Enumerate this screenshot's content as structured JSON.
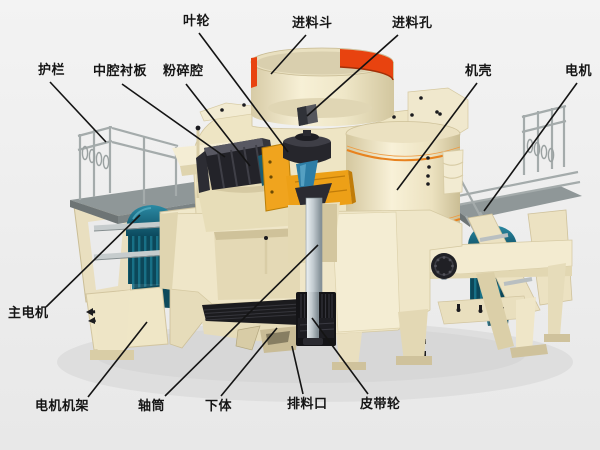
{
  "labels": [
    {
      "id": "impeller",
      "text": "叶轮",
      "tx": 183,
      "ty": 14,
      "line": {
        "x1": 199,
        "y1": 33,
        "x2": 288,
        "y2": 152
      }
    },
    {
      "id": "feed-hopper",
      "text": "进料斗",
      "tx": 292,
      "ty": 16,
      "line": {
        "x1": 306,
        "y1": 35,
        "x2": 271,
        "y2": 74
      }
    },
    {
      "id": "feed-opening",
      "text": "进料孔",
      "tx": 392,
      "ty": 16,
      "line": {
        "x1": 398,
        "y1": 35,
        "x2": 307,
        "y2": 116
      }
    },
    {
      "id": "guardrail",
      "text": "护栏",
      "tx": 38,
      "ty": 63,
      "line": {
        "x1": 50,
        "y1": 82,
        "x2": 106,
        "y2": 142
      }
    },
    {
      "id": "cavity-liner-plate",
      "text": "中腔衬板",
      "tx": 93,
      "ty": 64,
      "line": {
        "x1": 122,
        "y1": 84,
        "x2": 225,
        "y2": 157
      }
    },
    {
      "id": "crushing-chamber",
      "text": "粉碎腔",
      "tx": 163,
      "ty": 64,
      "line": {
        "x1": 186,
        "y1": 84,
        "x2": 250,
        "y2": 166
      }
    },
    {
      "id": "machine-casing",
      "text": "机壳",
      "tx": 465,
      "ty": 64,
      "line": {
        "x1": 477,
        "y1": 83,
        "x2": 397,
        "y2": 190
      }
    },
    {
      "id": "motor",
      "text": "电机",
      "tx": 565,
      "ty": 64,
      "line": {
        "x1": 577,
        "y1": 83,
        "x2": 484,
        "y2": 211
      }
    },
    {
      "id": "main-motor",
      "text": "主电机",
      "tx": 8,
      "ty": 306,
      "line": {
        "x1": 46,
        "y1": 307,
        "x2": 140,
        "y2": 215
      }
    },
    {
      "id": "motor-frame",
      "text": "电机机架",
      "tx": 35,
      "ty": 399,
      "line": {
        "x1": 88,
        "y1": 397,
        "x2": 147,
        "y2": 322
      }
    },
    {
      "id": "shaft-sleeve",
      "text": "轴筒",
      "tx": 138,
      "ty": 399,
      "line": {
        "x1": 165,
        "y1": 396,
        "x2": 318,
        "y2": 245
      }
    },
    {
      "id": "lower-body",
      "text": "下体",
      "tx": 205,
      "ty": 399,
      "line": {
        "x1": 221,
        "y1": 396,
        "x2": 277,
        "y2": 328
      }
    },
    {
      "id": "discharge-port",
      "text": "排料口",
      "tx": 287,
      "ty": 397,
      "line": {
        "x1": 303,
        "y1": 394,
        "x2": 292,
        "y2": 346
      }
    },
    {
      "id": "belt-pulley",
      "text": "皮带轮",
      "tx": 360,
      "ty": 397,
      "line": {
        "x1": 368,
        "y1": 394,
        "x2": 312,
        "y2": 318
      }
    }
  ],
  "colors": {
    "background": "#efefef",
    "body_cream": "#f2ead0",
    "body_cream_shade": "#d9cda6",
    "hopper_red_band": "#e8430f",
    "casing_orange_trim": "#e8821e",
    "impeller_orange": "#f0a41e",
    "motor_teal": "#0d4a5e",
    "metal_silver": "#b9c2c7",
    "dark_parts": "#1b1b1e",
    "railing_gray": "#a4abab",
    "deck_gray": "#8f9798",
    "label_text": "#151515",
    "leader_line": "#141414"
  }
}
